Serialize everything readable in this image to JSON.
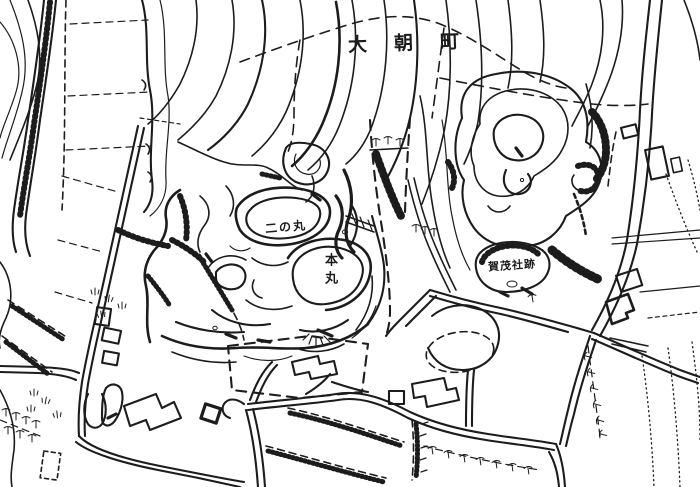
{
  "colors": {
    "paper": "#ffffff",
    "ink": "#1c1c1c"
  },
  "labels": {
    "town": {
      "text": "大朝町"
    },
    "ninomaru": {
      "text": "二の丸"
    },
    "honmaru": {
      "text": "本丸"
    },
    "shrine": {
      "text": "賀茂社跡"
    }
  }
}
